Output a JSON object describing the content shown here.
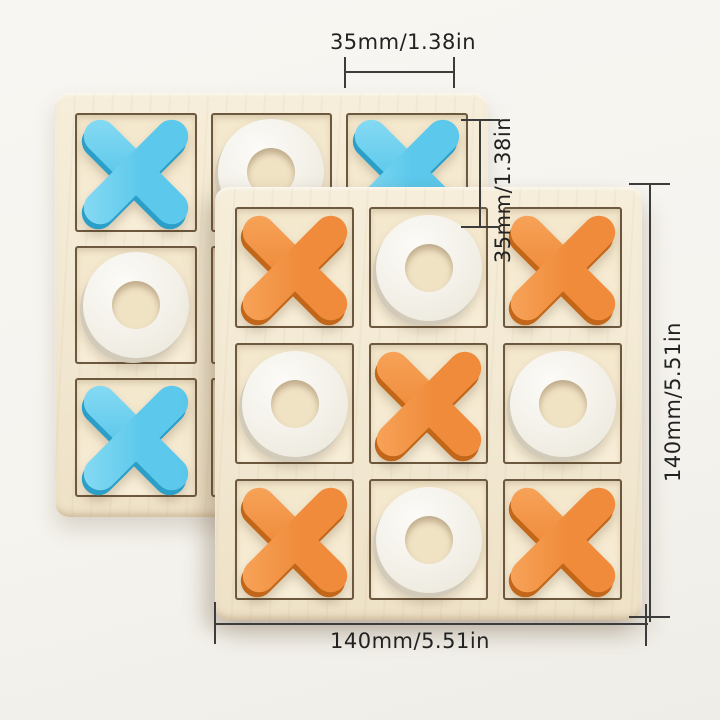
{
  "product": {
    "description": "wooden tic-tac-toe XO board game, two boards stacked",
    "dimensions": {
      "top_cell_width": "35mm/1.38in",
      "side_cell_height": "35mm/1.38in",
      "right_board_height": "140mm/5.51in",
      "bottom_board_width": "140mm/5.51in"
    },
    "boards": [
      {
        "id": "back-board",
        "x_color": "blue",
        "pieces": [
          [
            "X",
            "O",
            "X"
          ],
          [
            "O",
            "",
            ""
          ],
          [
            "X",
            "",
            ""
          ]
        ]
      },
      {
        "id": "front-board",
        "x_color": "orange",
        "pieces": [
          [
            "X",
            "O",
            "X"
          ],
          [
            "O",
            "X",
            "O"
          ],
          [
            "X",
            "O",
            "X"
          ]
        ]
      }
    ]
  },
  "colors": {
    "blue_piece": "#5cc8eb",
    "blue_piece_side": "#2b9fc8",
    "orange_piece": "#ef8b3a",
    "orange_piece_side": "#c2661a",
    "white_piece": "#f3f0e8",
    "white_piece_side": "#d2cbb9",
    "board_wood": "#f2e8d2",
    "cell_background": "#f6ebd2",
    "dimension_line": "#3c3c3c",
    "text": "#222222"
  }
}
